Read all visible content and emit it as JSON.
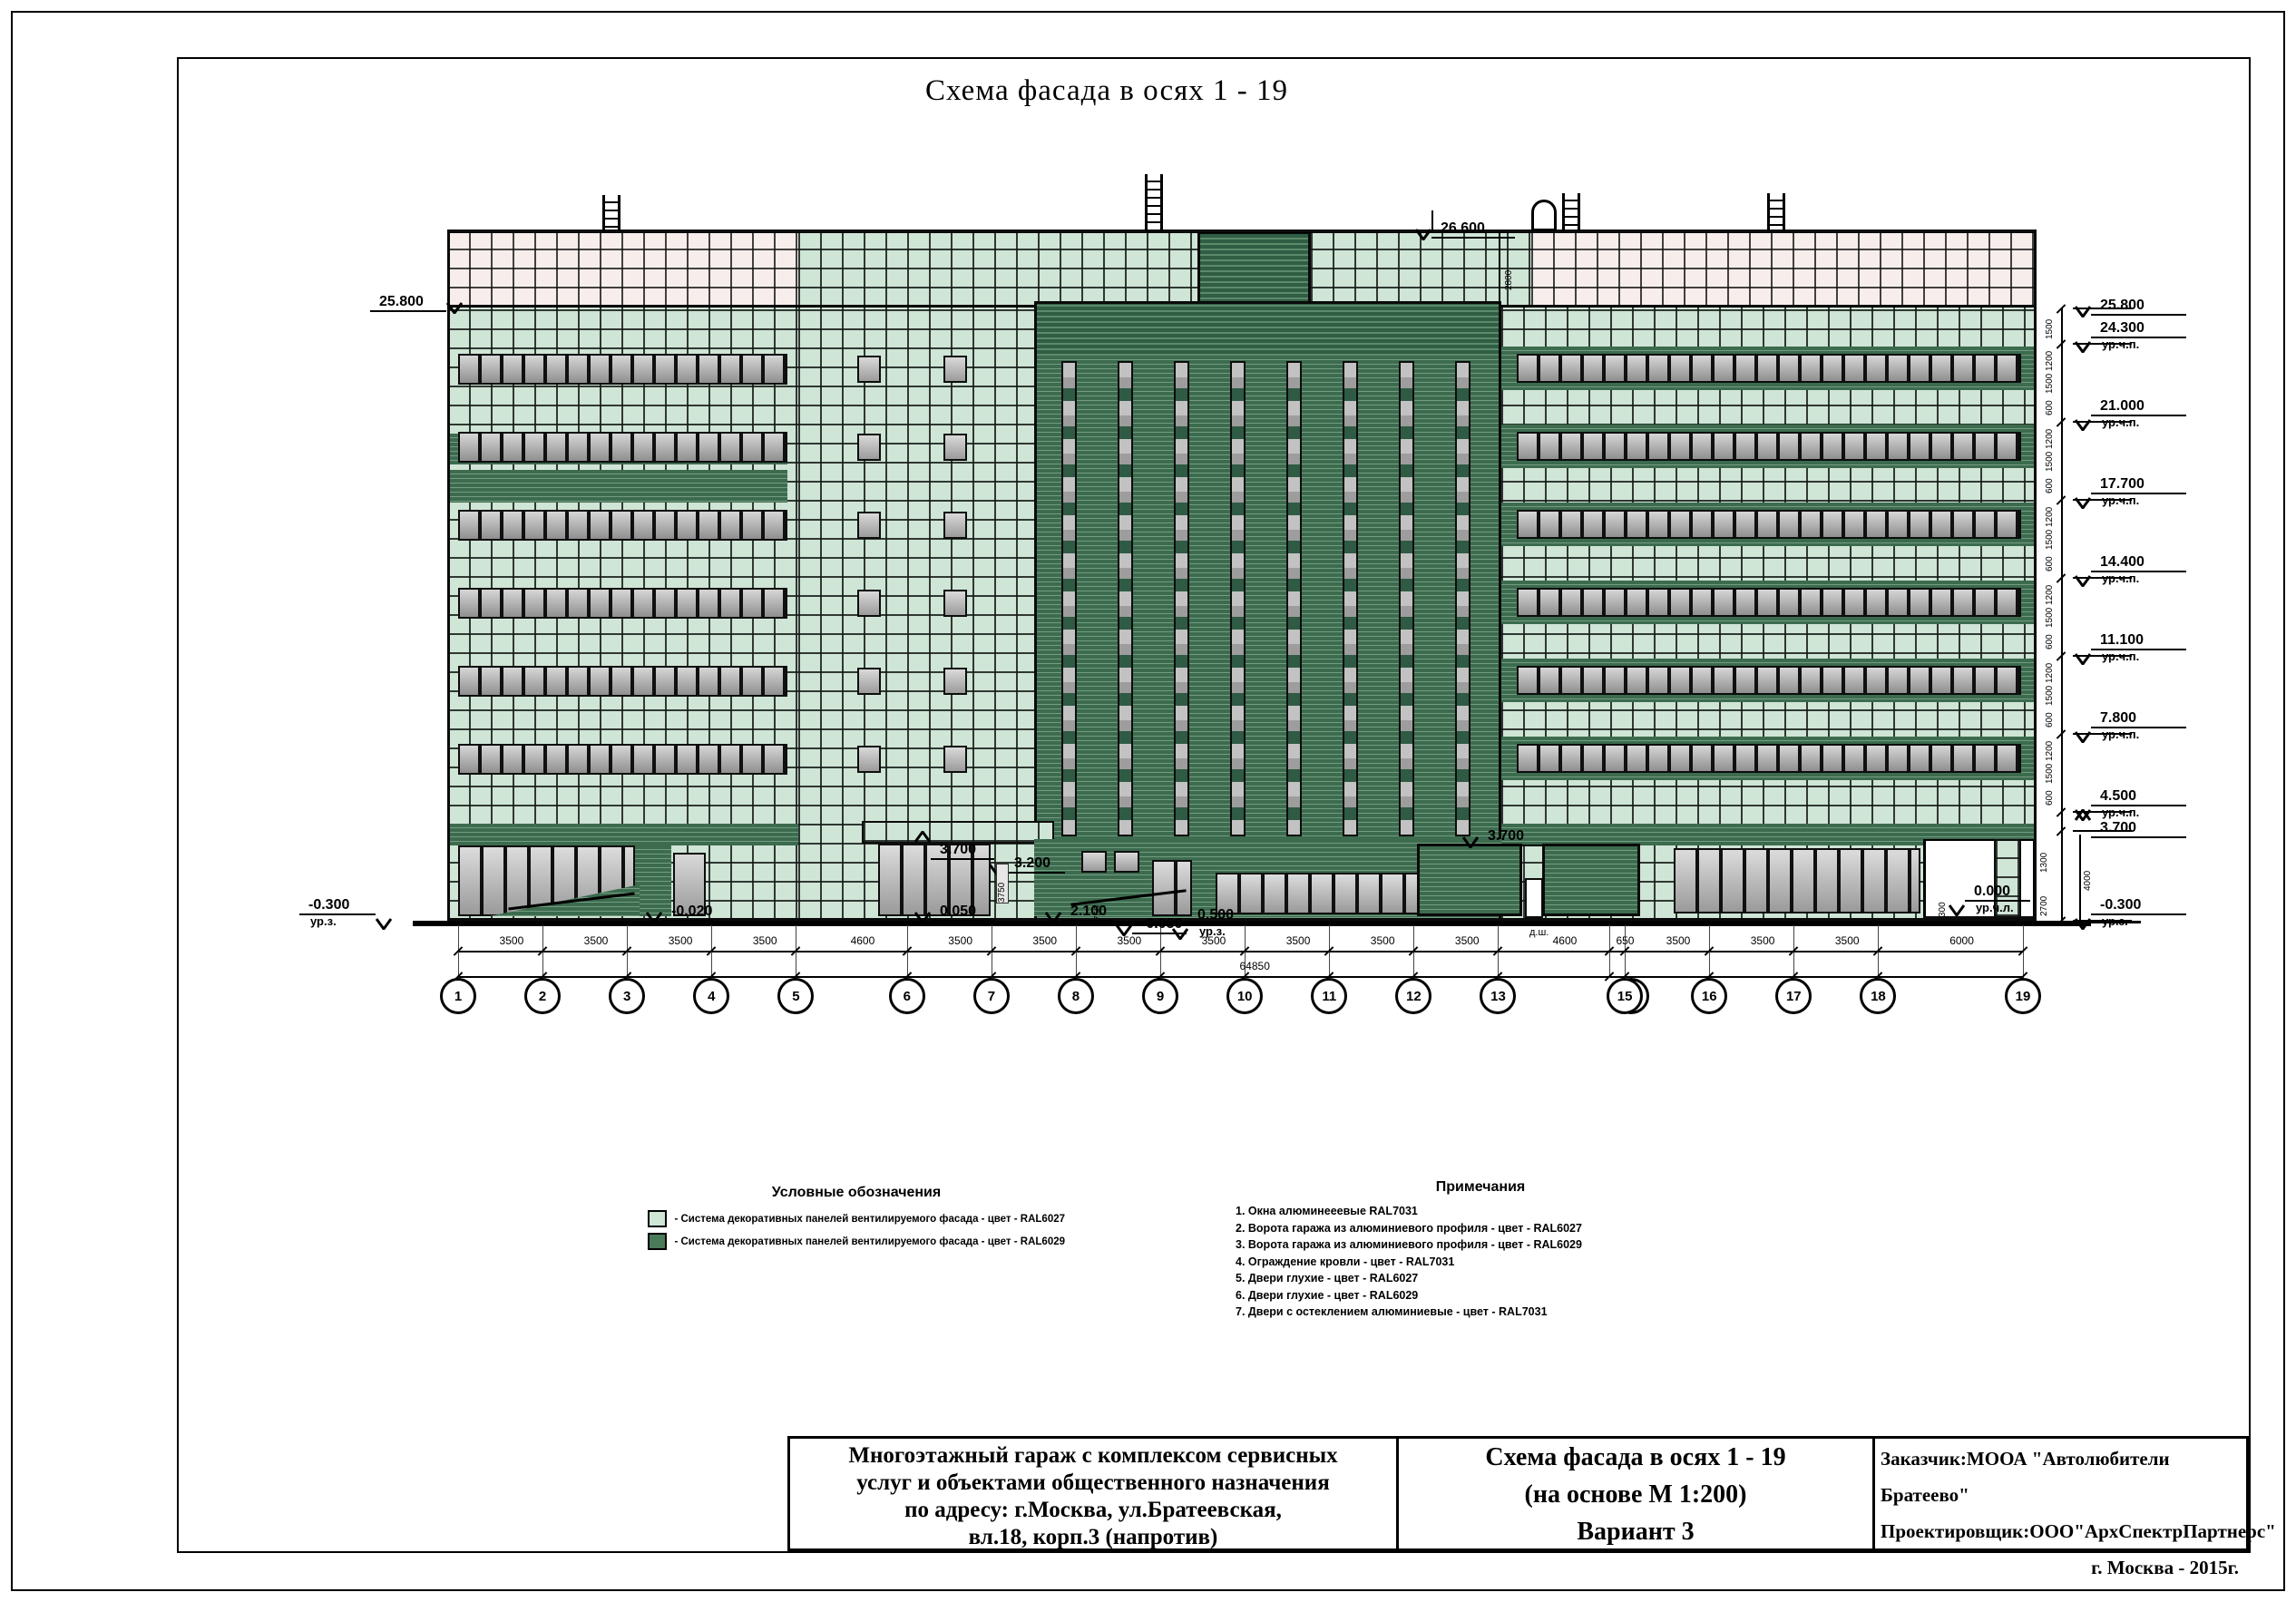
{
  "page_title": "Схема фасада в осях 1 - 19",
  "colors": {
    "panel_light_ral6027": "#cfe5d6",
    "panel_dark_ral6029": "#4a7a58",
    "parapet_pink": "#f7eeec",
    "window_gray": "#b9b9b9"
  },
  "legend": {
    "heading": "Условные обозначения",
    "items": [
      {
        "swatch": "#cfe5d6",
        "label": "- Система декоративных панелей вентилируемого фасада - цвет - RAL6027"
      },
      {
        "swatch": "#4a7a58",
        "label": "- Система декоративных панелей вентилируемого фасада - цвет - RAL6029"
      }
    ]
  },
  "notes": {
    "heading": "Примечания",
    "items": [
      "1. Окна алюминееевые RAL7031",
      "2. Ворота гаража из алюминиевого профиля - цвет - RAL6027",
      "3. Ворота гаража из алюминиевого профиля - цвет - RAL6029",
      "4. Ограждение кровли - цвет - RAL7031",
      "5. Двери глухие - цвет - RAL6027",
      "6. Двери глухие - цвет - RAL6029",
      "7. Двери с остеклением алюминиевые - цвет - RAL7031"
    ]
  },
  "title_block": {
    "project_lines": [
      "Многоэтажный гараж с комплексом сервисных",
      "услуг и объектами общественного назначения",
      "по адресу: г.Москва, ул.Братеевская,",
      "вл.18, корп.3 (напротив)"
    ],
    "sheet_lines": [
      "Схема фасада в осях 1 - 19",
      "(на основе М 1:200)",
      "Вариант 3"
    ],
    "info_lines": [
      "Заказчик:МООА \"Автолюбители Братеево\"",
      "Проектировщик:ООО\"АрхСпектрПартнерс\"",
      "г. Москва - 2015г."
    ]
  },
  "axes": {
    "numbers": [
      "1",
      "2",
      "3",
      "4",
      "5",
      "6",
      "7",
      "8",
      "9",
      "10",
      "11",
      "12",
      "13",
      "14",
      "15",
      "16",
      "17",
      "18",
      "19"
    ],
    "gaps_mm": [
      3500,
      3500,
      3500,
      3500,
      4600,
      3500,
      3500,
      3500,
      3500,
      3500,
      3500,
      3500,
      4600,
      650,
      3500,
      3500,
      3500,
      6000
    ],
    "total_label": "64850",
    "door_note": "д.ш."
  },
  "elevations_right": [
    {
      "value": "25.800",
      "sub": "",
      "dir": "down"
    },
    {
      "value": "24.300",
      "sub": "ур.ч.п.",
      "dir": "down"
    },
    {
      "value": "21.000",
      "sub": "ур.ч.п.",
      "dir": "down"
    },
    {
      "value": "17.700",
      "sub": "ур.ч.п.",
      "dir": "down"
    },
    {
      "value": "14.400",
      "sub": "ур.ч.п.",
      "dir": "down"
    },
    {
      "value": "11.100",
      "sub": "ур.ч.п.",
      "dir": "down"
    },
    {
      "value": "7.800",
      "sub": "ур.ч.п.",
      "dir": "down"
    },
    {
      "value": "4.500",
      "sub": "ур.ч.п.",
      "dir": "down"
    },
    {
      "value": "3.700",
      "sub": "",
      "dir": "up"
    },
    {
      "value": "-0.300",
      "sub": "ур.з.",
      "dir": "down"
    }
  ],
  "elevations_left": [
    {
      "value": "25.800",
      "sub": "",
      "dir": "down"
    },
    {
      "value": "-0.300",
      "sub": "ур.з.",
      "dir": "down"
    }
  ],
  "facade_marks": [
    {
      "value": "26.600",
      "sub": "",
      "dir": "down"
    },
    {
      "value": "3.700",
      "sub": "",
      "dir": "up"
    },
    {
      "value": "0.050",
      "sub": "",
      "dir": "down"
    },
    {
      "value": "3.200",
      "sub": "",
      "dir": "down"
    },
    {
      "value": "2.100",
      "sub": "",
      "dir": "down"
    },
    {
      "value": "-0.050",
      "sub": "",
      "dir": "down"
    },
    {
      "value": "0.500",
      "sub": "ур.з.",
      "dir": "down"
    },
    {
      "value": "3.700",
      "sub": "",
      "dir": "down"
    },
    {
      "value": "0.000",
      "sub": "ур.ч.л.",
      "dir": "down"
    },
    {
      "value": "-0.020",
      "sub": "",
      "dir": "down"
    }
  ],
  "small_dims": {
    "roof_height": "2800",
    "entry_height": "3750",
    "door_height": "750",
    "base_step": "300",
    "bottom_chain": [
      "1300",
      "2700"
    ],
    "bottom_total": "4000",
    "floor_chain": [
      "1200",
      "1500",
      "600"
    ],
    "top_chain": "1500"
  }
}
